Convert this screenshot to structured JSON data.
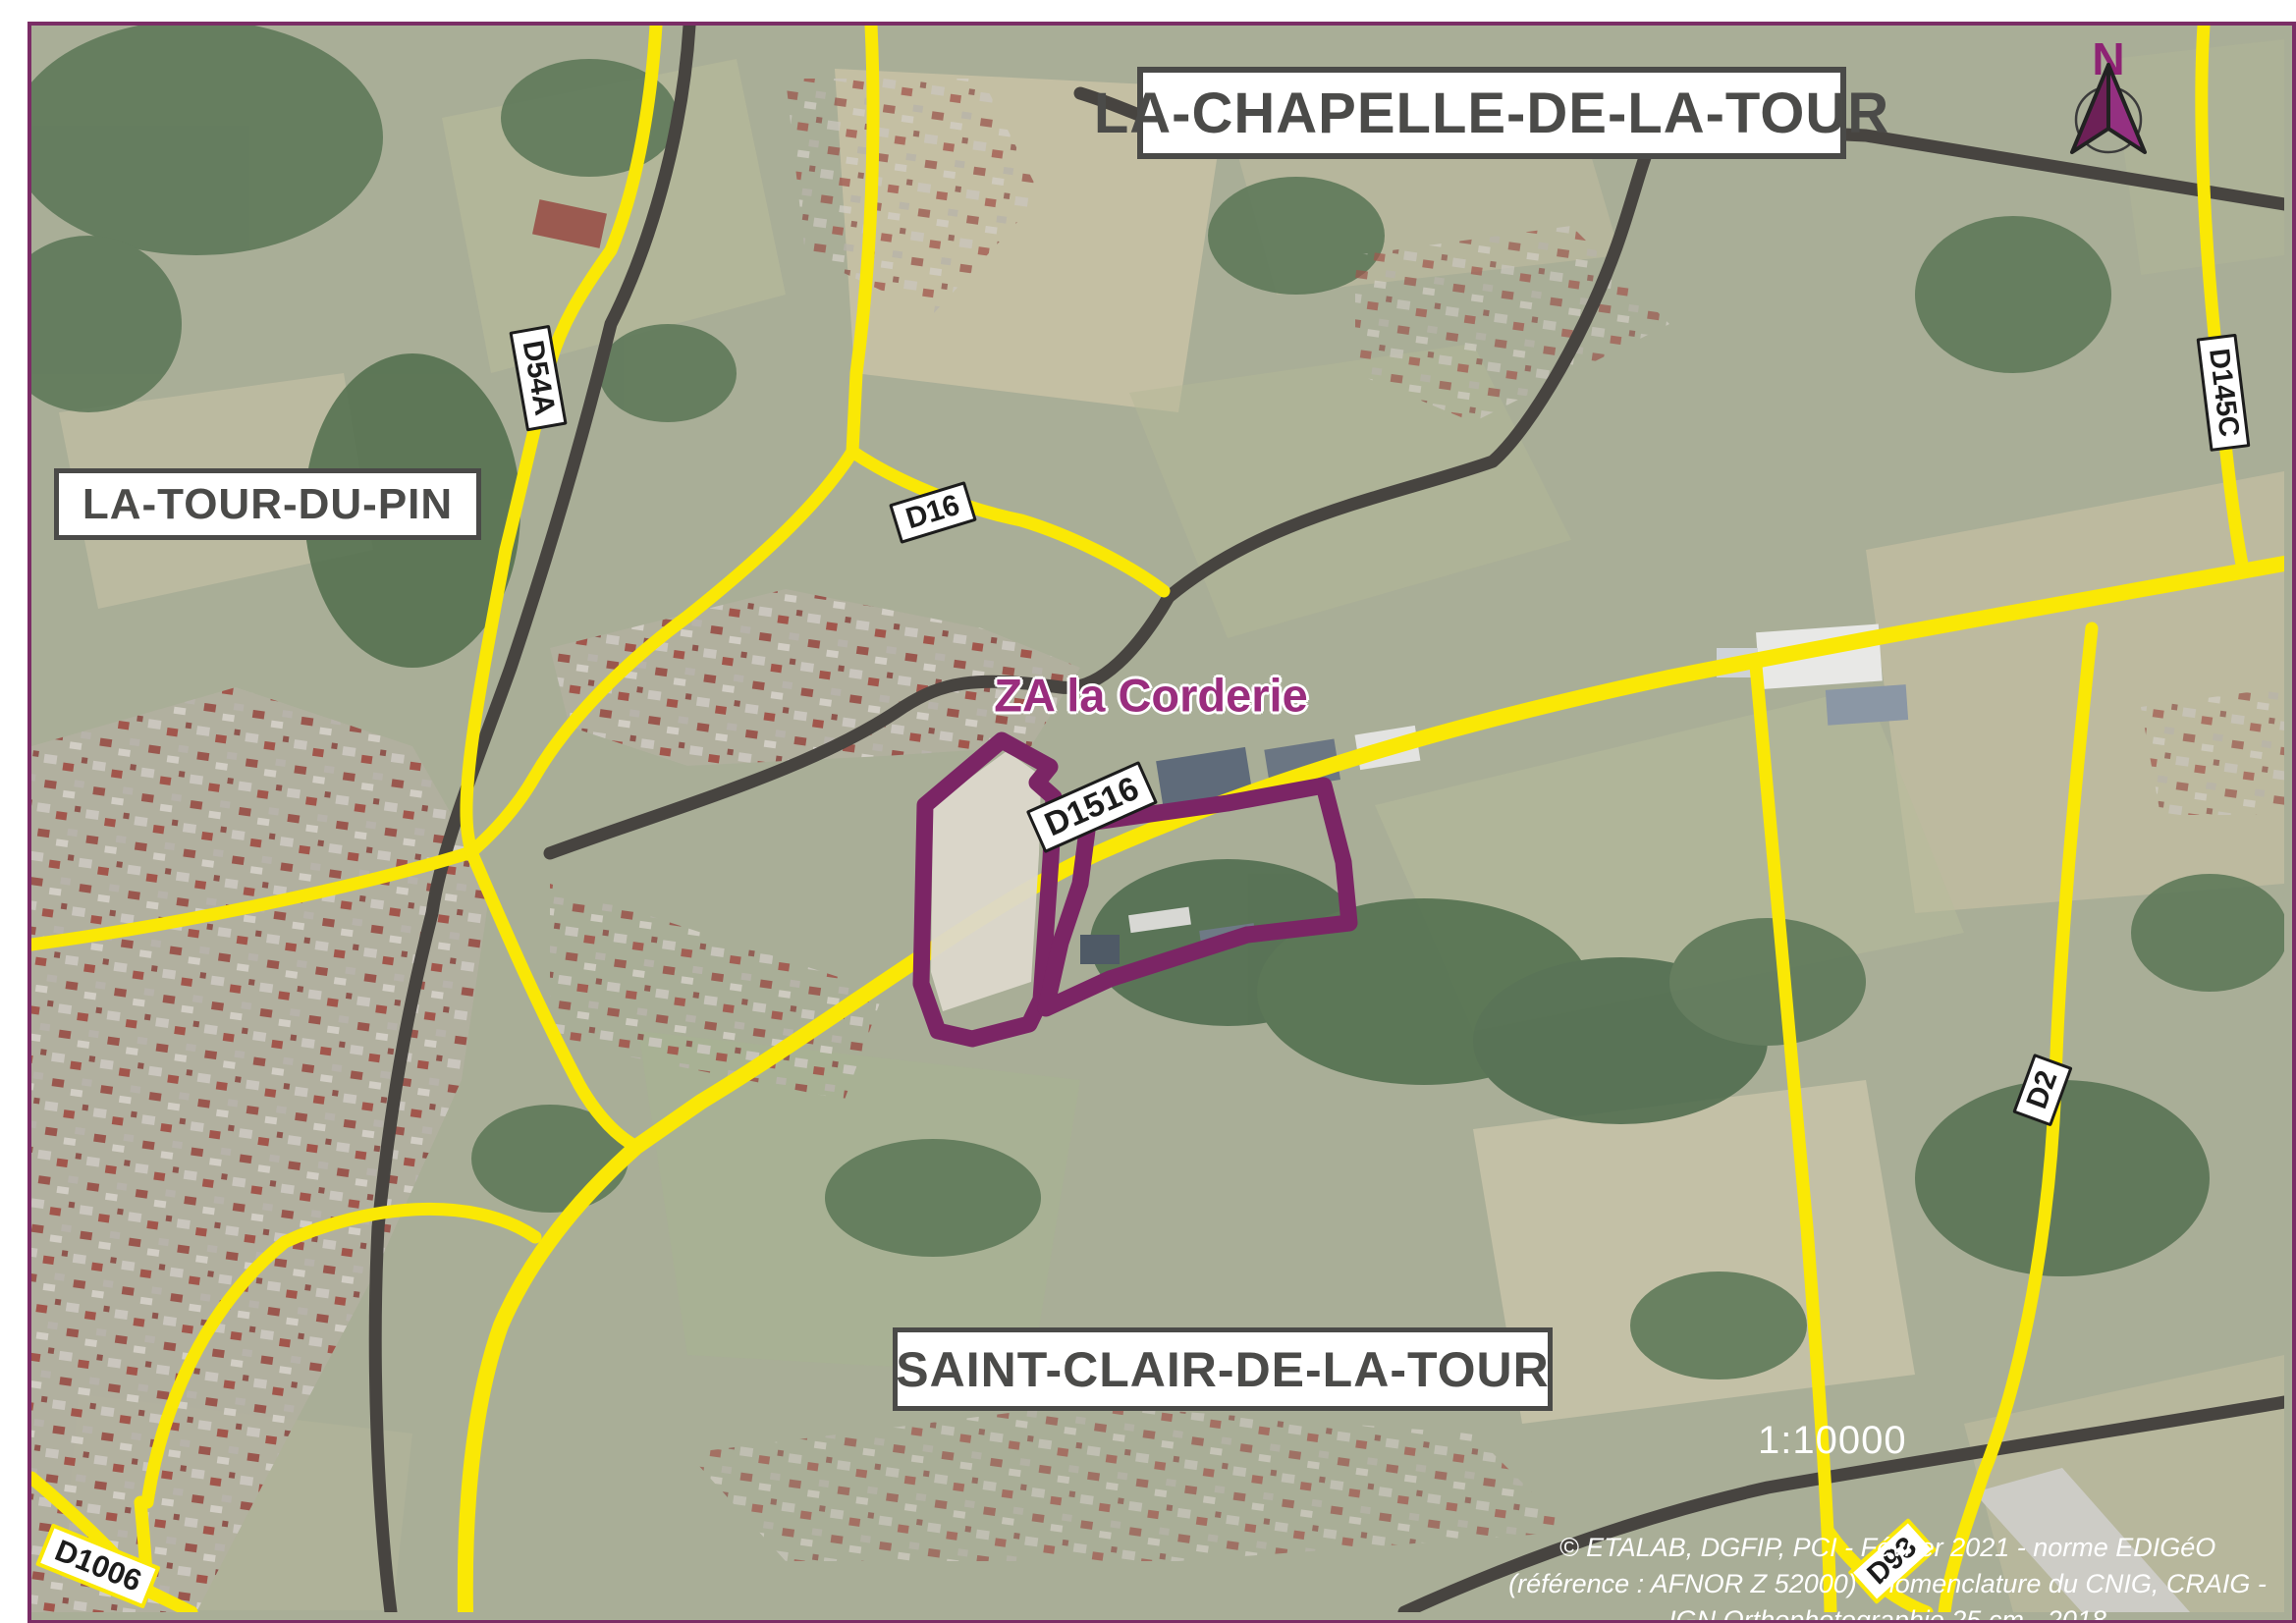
{
  "map": {
    "zone_label": "ZA la Corderie",
    "scale_text": "1:10000",
    "north_label": "N",
    "town_labels": [
      {
        "id": "la-chapelle-de-la-tour",
        "text": "LA-CHAPELLE-DE-LA-TOUR"
      },
      {
        "id": "la-tour-du-pin",
        "text": "LA-TOUR-DU-PIN"
      },
      {
        "id": "saint-clair-de-la-tour",
        "text": "SAINT-CLAIR-DE-LA-TOUR"
      }
    ],
    "road_labels": [
      {
        "id": "d54a",
        "text": "D54A"
      },
      {
        "id": "d16",
        "text": "D16"
      },
      {
        "id": "d1516",
        "text": "D1516"
      },
      {
        "id": "d145c",
        "text": "D145C"
      },
      {
        "id": "d2",
        "text": "D2"
      },
      {
        "id": "d1006",
        "text": "D1006"
      },
      {
        "id": "d93",
        "text": "D93"
      }
    ],
    "attribution": {
      "line1": "© ETALAB, DGFIP, PCI - Février 2021 - norme EDIGéO",
      "line2": "(référence : AFNOR Z 52000) - nomenclature du CNIG, CRAIG -",
      "line3": "IGN Orthophotographie 25 cm - 2018"
    },
    "colors": {
      "road_yellow": "#FAE805",
      "road_dark": "#474440",
      "parcel_purple": "#7B2565",
      "zone_text_purple": "#9A2D7E",
      "frame_purple": "#7B2D66",
      "label_text": "#4B4B49"
    }
  }
}
